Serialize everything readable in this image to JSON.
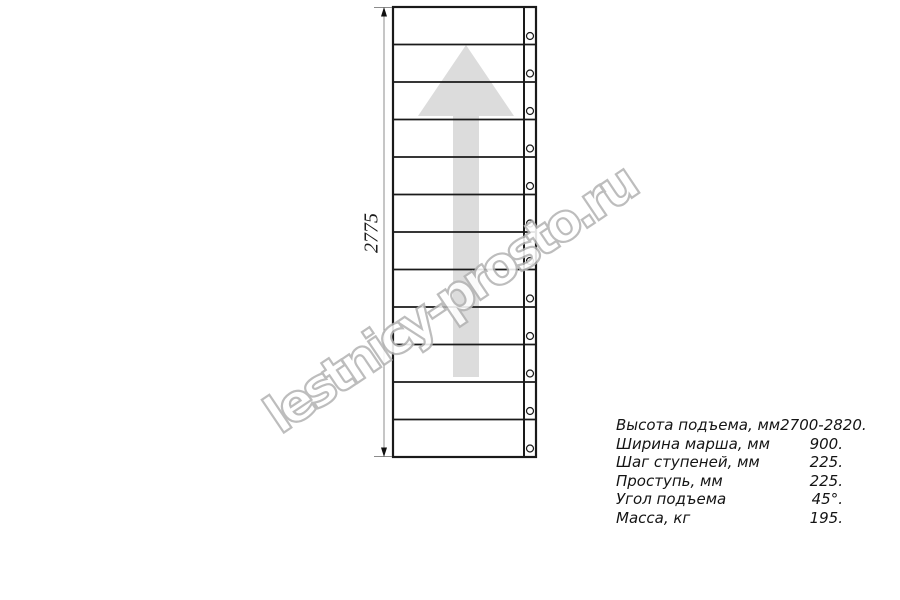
{
  "drawing": {
    "dimension_label": "2775",
    "treads": 12
  },
  "watermark": {
    "text": "lestnicy-prosto.ru"
  },
  "specs": {
    "rows": [
      {
        "label": "Высота подъема, мм",
        "value": "2700-2820."
      },
      {
        "label": "Ширина марша, мм",
        "value": "900."
      },
      {
        "label": "Шаг ступеней, мм",
        "value": "225."
      },
      {
        "label": "Проступь, мм",
        "value": "225."
      },
      {
        "label": "Угол подъема",
        "value": "45°."
      },
      {
        "label": "Масса, кг",
        "value": "195."
      }
    ]
  },
  "colors": {
    "line": "#1a1a1a",
    "dimension": "#8c8c8c",
    "arrow_fill": "#dcdcdc",
    "watermark_outline": "#b4b4b4",
    "text": "#141414"
  }
}
